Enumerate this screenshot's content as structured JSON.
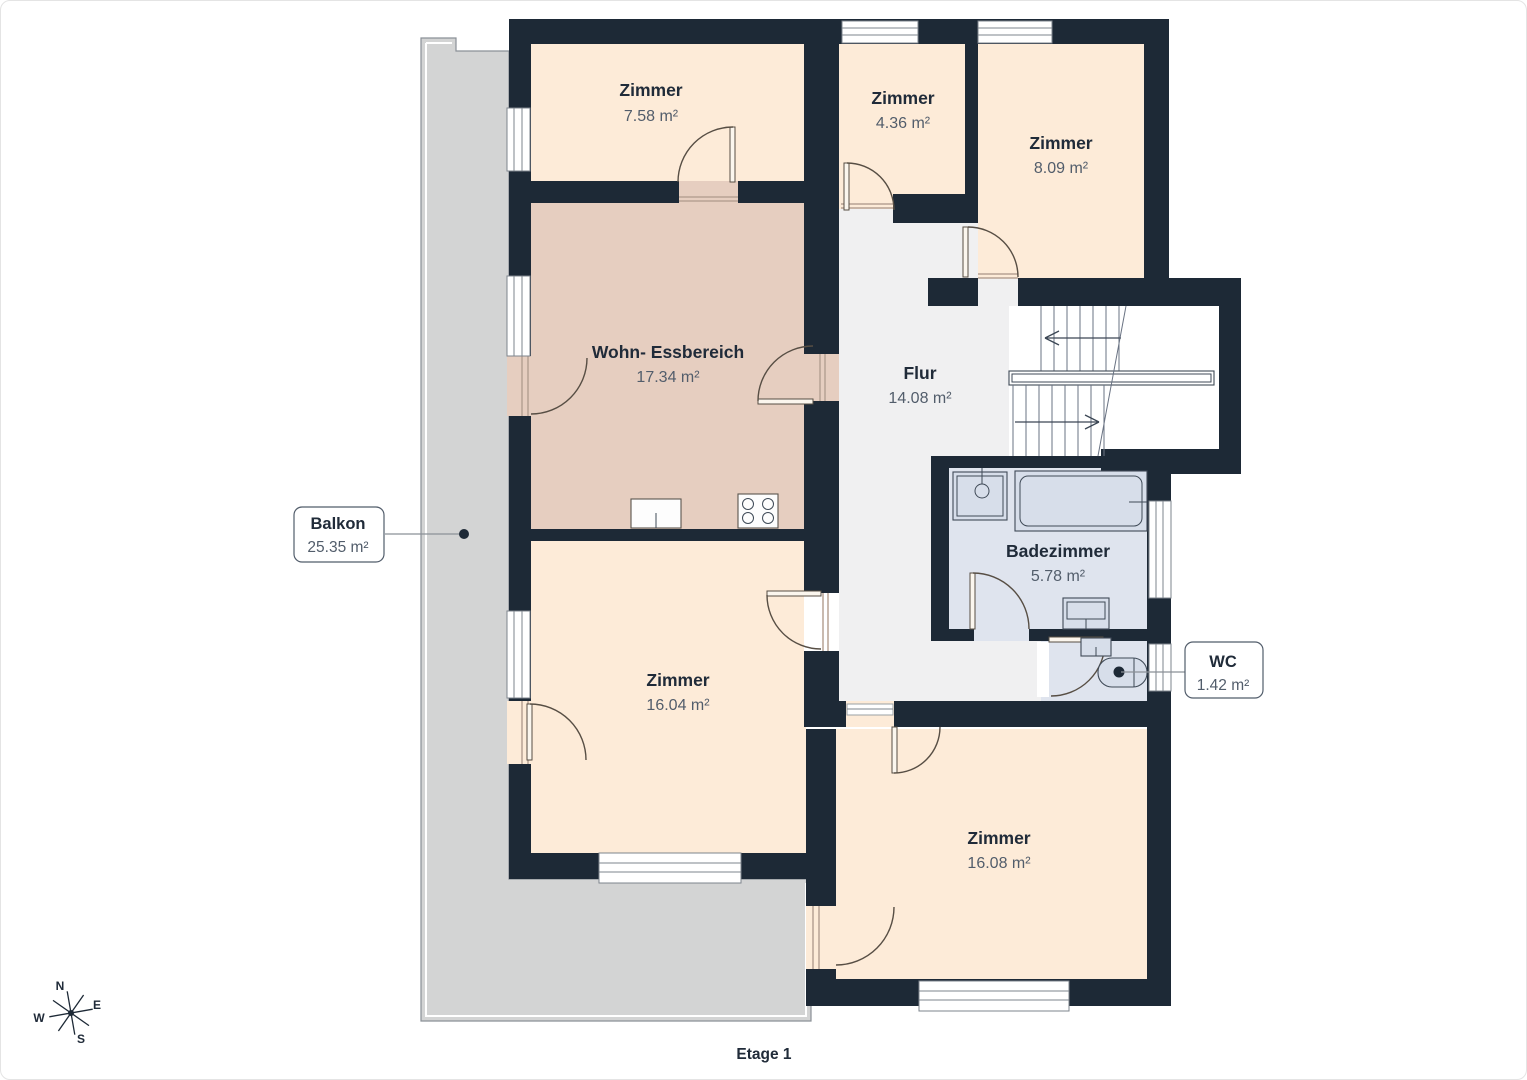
{
  "title": "Etage 1",
  "colors": {
    "wall": "#1d2936",
    "room_fill": "#fdebd8",
    "living_fill": "#e6cec0",
    "hall_fill": "#f0f0f1",
    "bath_fill": "#dfe4ee",
    "balcony_fill": "#d3d4d4",
    "text_dark": "#202b39",
    "text_area": "#525d6b"
  },
  "rooms": [
    {
      "name": "Zimmer",
      "area": "7.58 m²"
    },
    {
      "name": "Zimmer",
      "area": "4.36 m²"
    },
    {
      "name": "Zimmer",
      "area": "8.09 m²"
    },
    {
      "name": "Wohn- Essbereich",
      "area": "17.34 m²"
    },
    {
      "name": "Flur",
      "area": "14.08 m²"
    },
    {
      "name": "Badezimmer",
      "area": "5.78 m²"
    },
    {
      "name": "Zimmer",
      "area": "16.04 m²"
    },
    {
      "name": "Zimmer",
      "area": "16.08 m²"
    }
  ],
  "callouts": [
    {
      "name": "Balkon",
      "area": "25.35 m²"
    },
    {
      "name": "WC",
      "area": "1.42 m²"
    }
  ],
  "compass": {
    "n": "N",
    "e": "E",
    "s": "S",
    "w": "W"
  }
}
